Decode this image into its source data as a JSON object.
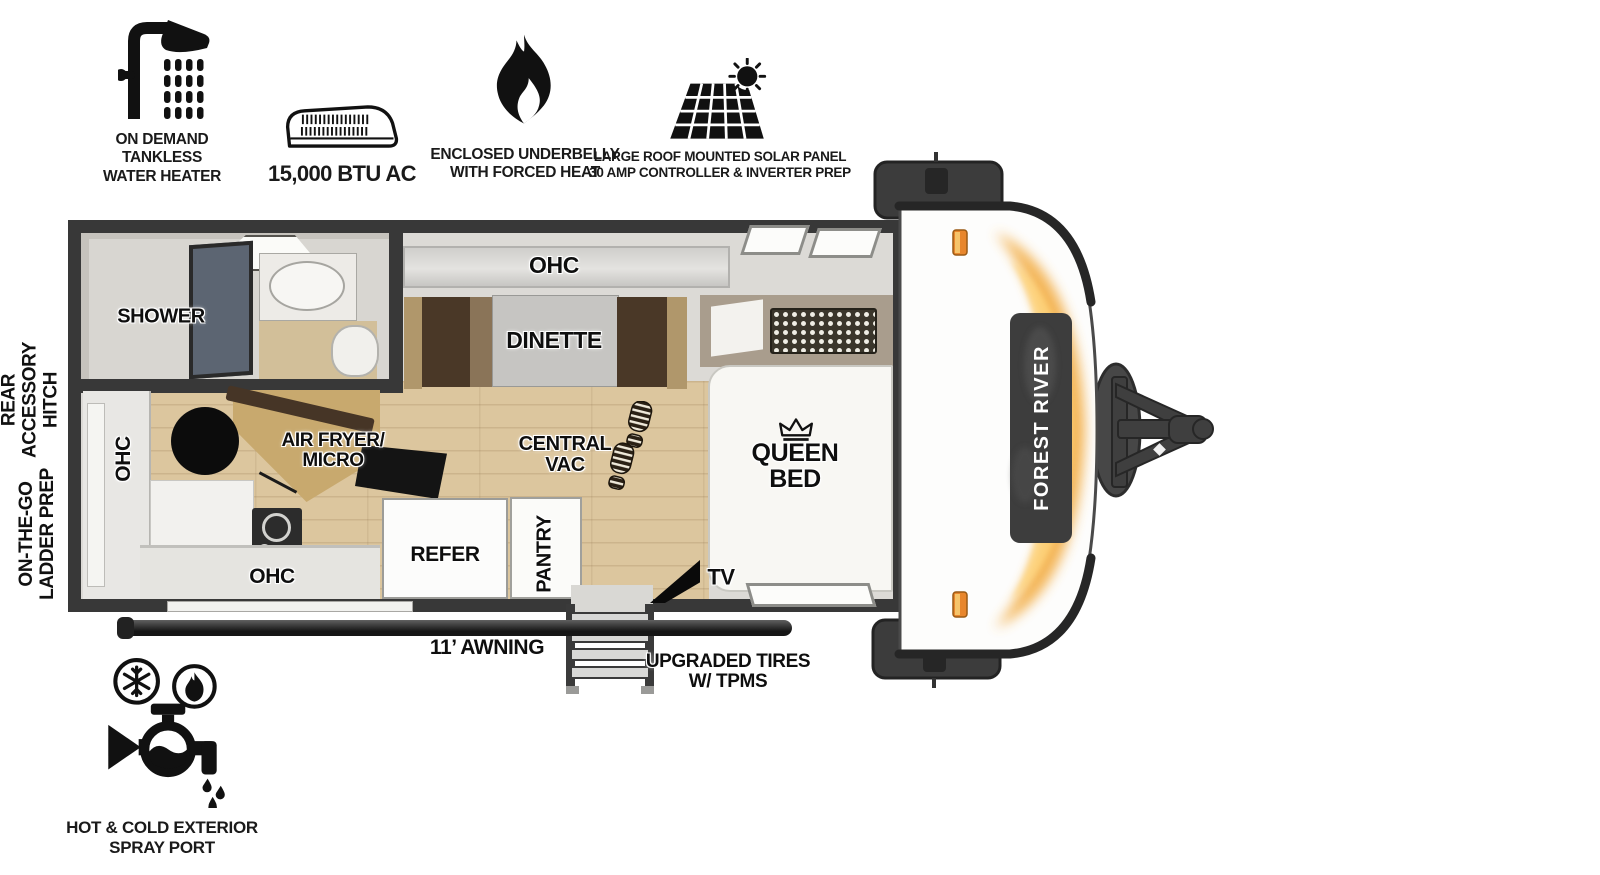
{
  "features": {
    "water_heater": {
      "label": "ON DEMAND\nTANKLESS\nWATER HEATER"
    },
    "ac": {
      "label": "15,000 BTU AC"
    },
    "underbelly": {
      "label": "ENCLOSED UNDERBELLY\nWITH FORCED HEAT"
    },
    "solar": {
      "label": "LARGE ROOF MOUNTED SOLAR PANEL\n30 AMP CONTROLLER & INVERTER PREP"
    },
    "spray_port": {
      "label": "HOT & COLD EXTERIOR\nSPRAY PORT"
    }
  },
  "floorplan": {
    "brand": "FOREST RIVER",
    "labels": {
      "shower": "SHOWER",
      "ohc_top": "OHC",
      "dinette": "DINETTE",
      "central_vac": "CENTRAL\nVAC",
      "queen_bed": "QUEEN BED",
      "air_fryer": "AIR FRYER/\nMICRO",
      "ohc_left": "OHC",
      "ohc_bottom": "OHC",
      "refer": "REFER",
      "pantry": "PANTRY",
      "tv": "TV"
    },
    "exterior": {
      "awning": "11’ AWNING",
      "tires": "UPGRADED TIRES\nW/ TPMS",
      "rear_hitch": "REAR\nACCESSORY\nHITCH",
      "ladder_prep": "ON-THE-GO\nLADDER PREP"
    }
  },
  "colors": {
    "structure": "#3a3a3a",
    "accent_orange": "#e8862c",
    "front_gold": "#f2a93b",
    "wood_floor": "#dcc69e"
  }
}
